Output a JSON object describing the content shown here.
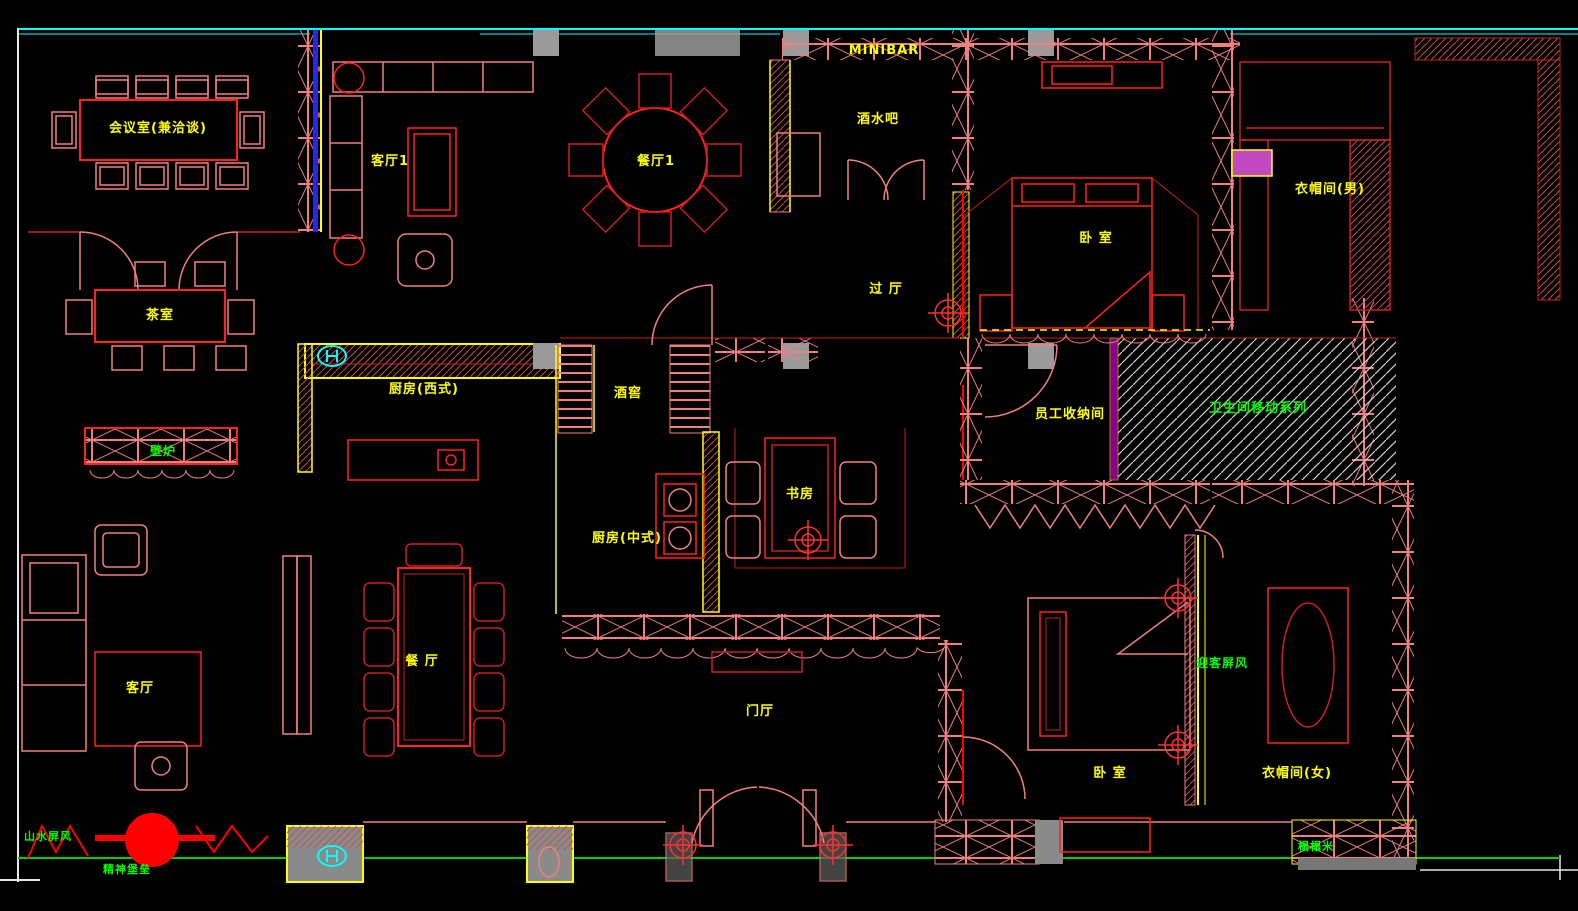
{
  "drawing": {
    "background": "#000000",
    "type": "interior-floor-plan",
    "colors": {
      "wall": "#F08080",
      "furniture_red": "#FF2020",
      "outline_red": "#C82020",
      "label_yellow": "#FFFF00",
      "annotation_green": "#00FF00",
      "frame_cyan": "#00FFFF",
      "frame_white": "#FFFFFF",
      "pier_gray": "#8A8A8A",
      "hatch_blue": "#2424FF",
      "hatch_magenta": "#FF00FF"
    }
  },
  "labels": [
    {
      "id": "meeting-room",
      "text": "会议室(兼洽谈)",
      "x": 158,
      "y": 132,
      "color": "#FFFF00",
      "size": 13
    },
    {
      "id": "living-room-1",
      "text": "客厅1",
      "x": 390,
      "y": 165,
      "color": "#FFFF00",
      "size": 13
    },
    {
      "id": "dining-room-1",
      "text": "餐厅1",
      "x": 656,
      "y": 165,
      "color": "#FFFF00",
      "size": 13
    },
    {
      "id": "minibar",
      "text": "MINIBAR",
      "x": 884,
      "y": 54,
      "color": "#FFFF00",
      "size": 13
    },
    {
      "id": "drinks-bar",
      "text": "酒水吧",
      "x": 878,
      "y": 123,
      "color": "#FFFF00",
      "size": 13
    },
    {
      "id": "cloakroom-male",
      "text": "衣帽间(男)",
      "x": 1330,
      "y": 193,
      "color": "#FFFF00",
      "size": 13
    },
    {
      "id": "bedroom-top",
      "text": "卧 室",
      "x": 1096,
      "y": 242,
      "color": "#FFFF00",
      "size": 13
    },
    {
      "id": "passage-hall",
      "text": "过 厅",
      "x": 886,
      "y": 293,
      "color": "#FFFF00",
      "size": 13
    },
    {
      "id": "tea-room",
      "text": "茶室",
      "x": 160,
      "y": 319,
      "color": "#FFFF00",
      "size": 13
    },
    {
      "id": "kitchen-west",
      "text": "厨房(西式)",
      "x": 424,
      "y": 393,
      "color": "#FFFF00",
      "size": 13
    },
    {
      "id": "wine-cellar",
      "text": "酒窖",
      "x": 628,
      "y": 397,
      "color": "#FFFF00",
      "size": 13
    },
    {
      "id": "staff-storage",
      "text": "员工收纳间",
      "x": 1070,
      "y": 418,
      "color": "#FFFF00",
      "size": 13
    },
    {
      "id": "bathroom-series",
      "text": "卫生间移动系列",
      "x": 1258,
      "y": 412,
      "color": "#00FF00",
      "size": 13
    },
    {
      "id": "study",
      "text": "书房",
      "x": 800,
      "y": 498,
      "color": "#FFFF00",
      "size": 13
    },
    {
      "id": "kitchen-chinese",
      "text": "厨房(中式)",
      "x": 627,
      "y": 542,
      "color": "#FFFF00",
      "size": 13
    },
    {
      "id": "fireplace",
      "text": "壁炉",
      "x": 163,
      "y": 455,
      "color": "#00FF00",
      "size": 12
    },
    {
      "id": "living-room",
      "text": "客厅",
      "x": 140,
      "y": 692,
      "color": "#FFFF00",
      "size": 13
    },
    {
      "id": "dining-room",
      "text": "餐 厅",
      "x": 422,
      "y": 665,
      "color": "#FFFF00",
      "size": 13
    },
    {
      "id": "entrance-hall",
      "text": "门厅",
      "x": 760,
      "y": 715,
      "color": "#FFFF00",
      "size": 13
    },
    {
      "id": "welcome-screen",
      "text": "迎客屏风",
      "x": 1222,
      "y": 667,
      "color": "#00FF00",
      "size": 12
    },
    {
      "id": "bedroom-bottom",
      "text": "卧 室",
      "x": 1110,
      "y": 777,
      "color": "#FFFF00",
      "size": 13
    },
    {
      "id": "cloakroom-female",
      "text": "衣帽间(女)",
      "x": 1297,
      "y": 777,
      "color": "#FFFF00",
      "size": 13
    },
    {
      "id": "landscape-screen",
      "text": "山水屏风",
      "x": 48,
      "y": 840,
      "color": "#00FF00",
      "size": 11
    },
    {
      "id": "spirit-totem",
      "text": "精神堡垒",
      "x": 127,
      "y": 873,
      "color": "#00FF00",
      "size": 11
    },
    {
      "id": "tatami",
      "text": "榻榻米",
      "x": 1316,
      "y": 850,
      "color": "#00FF00",
      "size": 11
    }
  ]
}
